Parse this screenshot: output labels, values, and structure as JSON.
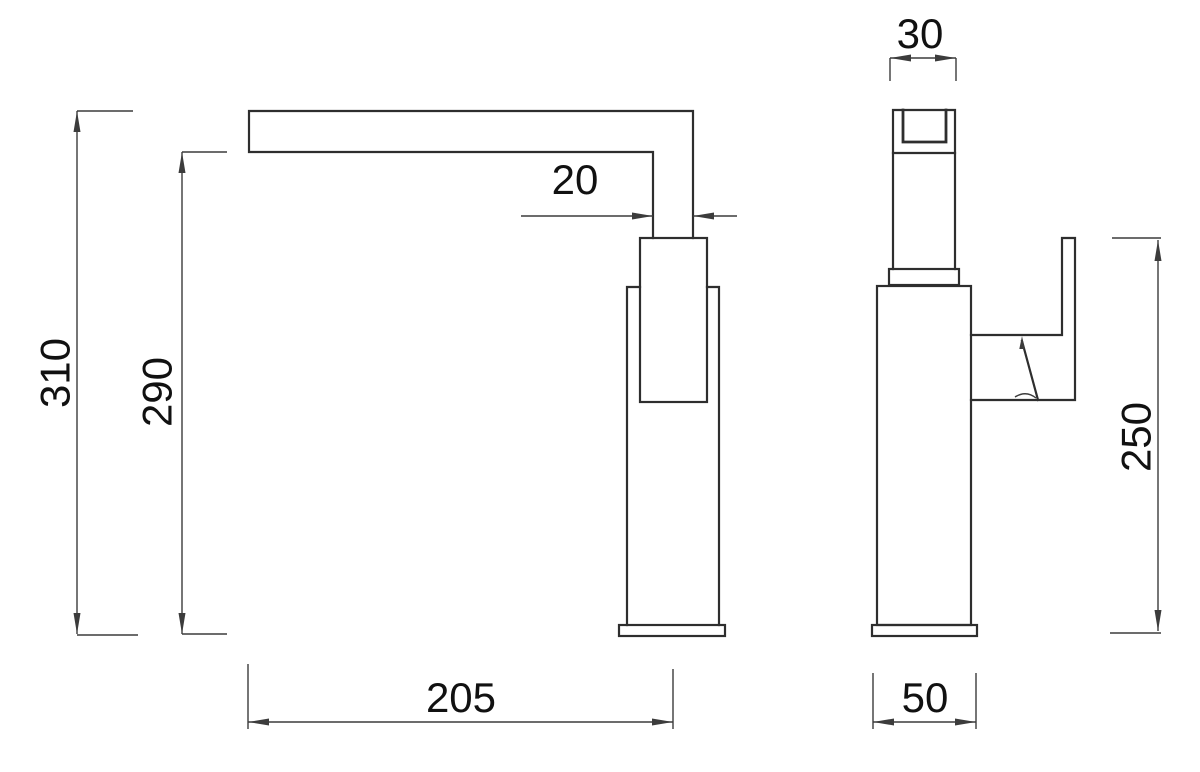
{
  "drawing": {
    "type": "technical-drawing",
    "subject": "kitchen mixer faucet, two orthographic views with dimensions (mm)",
    "views": [
      {
        "name": "side-view",
        "dimensions": [
          {
            "label": "310",
            "orientation": "vertical",
            "measures": "overall height to top of spout"
          },
          {
            "label": "290",
            "orientation": "vertical",
            "measures": "height to underside of spout arm"
          },
          {
            "label": "20",
            "orientation": "horizontal",
            "measures": "spout neck width"
          },
          {
            "label": "205",
            "orientation": "horizontal",
            "measures": "spout reach from spout tip to body centreline"
          }
        ]
      },
      {
        "name": "front-view",
        "dimensions": [
          {
            "label": "30",
            "orientation": "horizontal",
            "measures": "spout arm width"
          },
          {
            "label": "250",
            "orientation": "vertical",
            "measures": "height to top of handle lever"
          },
          {
            "label": "50",
            "orientation": "horizontal",
            "measures": "body width"
          }
        ]
      }
    ],
    "colors": {
      "background": "#ffffff",
      "object_line": "#2e2e2e",
      "dimension_line": "#3c3c3c",
      "text": "#111111"
    }
  }
}
